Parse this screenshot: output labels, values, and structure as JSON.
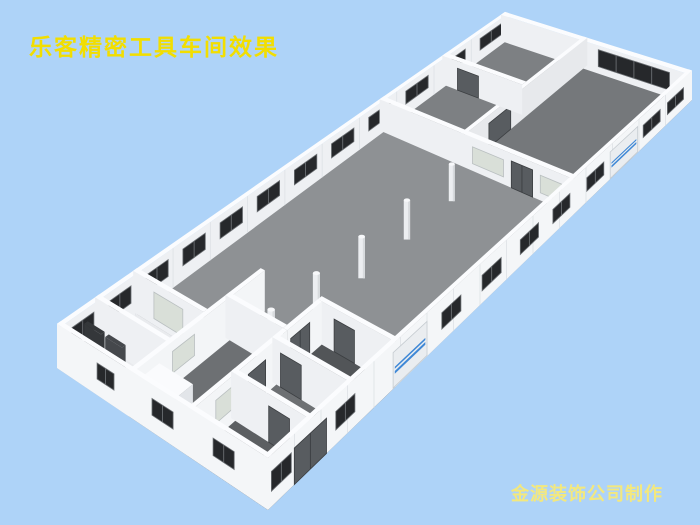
{
  "texts": {
    "title": "乐客精密工具车间效果",
    "credit": "金源装饰公司制作",
    "title_color": "#f2de00",
    "credit_color": "#f3e87e"
  },
  "background_color": "#aed3f8",
  "scene": {
    "description": "bird's-eye 3D render of workshop floor plan: long white building, gray hall floor, row of columns, office rooms at both ends, dark windows, blue-striped roll-up doors",
    "proj": {
      "W": [
        57,
        368
      ],
      "N": [
        505,
        38
      ],
      "S": [
        268,
        510
      ],
      "E": [
        692,
        100
      ]
    },
    "h0": 24,
    "hs": 0.055,
    "ta": 0.009,
    "tb": 0.02,
    "colH": 1.06,
    "colW": 0.17,
    "rollStripes": [
      [
        0.36,
        0.44
      ],
      [
        0.5,
        0.56
      ]
    ],
    "colors": {
      "wallTop": "#fbfcfe",
      "wallIn": "#eef0f3",
      "wallBright": "#f3f5f7",
      "wallMid": "#e7e9ec",
      "wallExt": "#f4f6f8",
      "seam": "#dde1e5",
      "floorHall": "#8e9194",
      "floorRoomA": "#7d8083",
      "floorRoomB": "#75787b",
      "floorRoomC": "#6d7073",
      "floorDark": "#5c5f62",
      "floorDark2": "#525558",
      "floorBath": "#e9ebee",
      "win": "#26282b",
      "winFrame": "#6a6e72",
      "frost": "#d9dfd8",
      "frostFrame": "#b9bfc0",
      "door": "#585c60",
      "doorFrame": "#3b3e41",
      "roll": "#eaedf0",
      "rollFrame": "#c6ccd1",
      "rollStripe": "#3f88d6",
      "colBody": "#eceef1",
      "colShade": "#d8dbde",
      "colTop": "#f7f8fa",
      "panelDark": "#34373a",
      "panelDark2": "#45484c",
      "boxTop": "#fafbfd",
      "boxFaceA": "#eef0f3",
      "boxFaceB": "#e2e5e9"
    },
    "floors": [
      {
        "a": [
          0,
          1
        ],
        "b": [
          0,
          1
        ],
        "c": "floorHall",
        "name": "main-hall-floor"
      },
      {
        "a": [
          0.72,
          1
        ],
        "b": [
          0,
          0.42
        ],
        "c": "floorRoomA",
        "name": "office-strip-floor"
      },
      {
        "a": [
          0.72,
          1
        ],
        "b": [
          0.42,
          1
        ],
        "c": "floorRoomB",
        "name": "big-office-floor"
      },
      {
        "a": [
          0,
          0.22
        ],
        "b": [
          0.34,
          0.62
        ],
        "c": "floorRoomC",
        "name": "corridor-floor"
      },
      {
        "a": [
          0,
          0.3
        ],
        "b": [
          0.62,
          1
        ],
        "c": "floorRoomC",
        "name": "rooms-floor"
      },
      {
        "a": [
          0,
          0.1
        ],
        "b": [
          0.62,
          1
        ],
        "c": "floorDark",
        "name": "room-floor-dark"
      },
      {
        "a": [
          0.22,
          0.3
        ],
        "b": [
          0.62,
          1
        ],
        "c": "floorDark2",
        "name": "corner-room-floor"
      },
      {
        "a": [
          0,
          0.17
        ],
        "b": [
          0,
          0.34
        ],
        "c": "floorBath",
        "name": "washroom-floor"
      }
    ],
    "columns": [
      [
        0.65,
        0.53
      ],
      [
        0.547,
        0.53
      ],
      [
        0.443,
        0.53
      ],
      [
        0.339,
        0.53
      ],
      [
        0.235,
        0.53
      ]
    ],
    "objects": [
      {
        "kind": "wall",
        "name": "nw-exterior-wall",
        "t": "L",
        "b": 0,
        "a1": 0,
        "a2": 1,
        "face": "wallIn",
        "seams": 0.0833,
        "f": [
          {
            "kind": "winrow",
            "start": 0.048,
            "step": 0.083,
            "n": 12,
            "w": 0.05,
            "v": [
              0.38,
              0.8
            ],
            "panes": 2
          }
        ]
      },
      {
        "kind": "wall",
        "name": "ne-exterior-wall",
        "t": "C",
        "a": 0.991,
        "b1": 0,
        "b2": 1,
        "face": "wallIn",
        "f": [
          {
            "kind": "win",
            "r": [
              0.52,
              0.9
            ],
            "v": [
              0.25,
              0.85
            ],
            "panes": 4
          }
        ]
      },
      {
        "kind": "wall",
        "name": "office-long-partition",
        "t": "L",
        "b": 0.42,
        "a1": 0.72,
        "a2": 1,
        "face": "wallMid",
        "f": [
          {
            "kind": "door",
            "r": [
              0.775,
              0.825
            ],
            "v": [
              0,
              0.75
            ]
          }
        ]
      },
      {
        "kind": "wall",
        "name": "office-cross-partition",
        "t": "C",
        "a": 0.86,
        "b1": 0,
        "b2": 0.42,
        "face": "wallIn",
        "f": [
          {
            "kind": "door",
            "r": [
              0.08,
              0.19
            ],
            "v": [
              0,
              0.75
            ]
          }
        ]
      },
      {
        "kind": "wall",
        "name": "hall-office-partition",
        "t": "C",
        "a": 0.72,
        "b1": 0,
        "b2": 1,
        "face": "wallIn",
        "f": [
          {
            "kind": "frost",
            "r": [
              0.48,
              0.64
            ],
            "v": [
              0.22,
              0.72
            ]
          },
          {
            "kind": "door",
            "r": [
              0.68,
              0.79
            ],
            "v": [
              0,
              0.78
            ],
            "panes": 2
          },
          {
            "kind": "frost",
            "r": [
              0.83,
              0.94
            ],
            "v": [
              0.22,
              0.72
            ]
          }
        ]
      },
      {
        "kind": "columns"
      },
      {
        "kind": "wall",
        "name": "washroom-wall-ne",
        "t": "C",
        "a": 0.17,
        "b1": 0,
        "b2": 0.34,
        "face": "wallIn",
        "f": [
          {
            "kind": "frost",
            "r": [
              0.1,
              0.24
            ],
            "v": [
              0.15,
              0.78
            ]
          }
        ]
      },
      {
        "kind": "box",
        "name": "washroom-fixture",
        "a1": 0.09,
        "a2": 0.125,
        "b1": 0.05,
        "b2": 0.13,
        "k": 0.32
      },
      {
        "kind": "box",
        "name": "washroom-fixture",
        "a1": 0.09,
        "a2": 0.125,
        "b1": 0.16,
        "b2": 0.24,
        "k": 0.32
      },
      {
        "kind": "box",
        "name": "washroom-counter",
        "a1": 0.1,
        "a2": 0.14,
        "b1": 0.26,
        "b2": 0.33,
        "k": 0.26
      },
      {
        "kind": "wall",
        "name": "washroom-partition",
        "t": "C",
        "a": 0.085,
        "b1": 0,
        "b2": 0.34,
        "face": "wallIn"
      },
      {
        "kind": "box",
        "name": "dark-partition-panel",
        "a1": 0.042,
        "a2": 0.05,
        "b1": 0.04,
        "b2": 0.12,
        "k": 0.82,
        "fa": "panelDark",
        "fb": "panelDark",
        "top": "panelDark"
      },
      {
        "kind": "box",
        "name": "dark-partition-panel",
        "a1": 0.042,
        "a2": 0.05,
        "b1": 0.14,
        "b2": 0.22,
        "k": 0.82,
        "fa": "panelDark2",
        "fb": "panelDark2",
        "top": "panelDark2"
      },
      {
        "kind": "wall",
        "name": "corridor-wall",
        "t": "L",
        "b": 0.34,
        "a1": 0,
        "a2": 0.3,
        "face": "wallBright",
        "f": [
          {
            "kind": "frost",
            "r": [
              0.09,
              0.14
            ],
            "v": [
              0.3,
              0.78
            ]
          }
        ]
      },
      {
        "kind": "box",
        "name": "low-room-block",
        "a1": 0.005,
        "a2": 0.06,
        "b1": 0.36,
        "b2": 0.52,
        "k": 0.75
      },
      {
        "kind": "wall",
        "name": "corner-room-wall-ne",
        "t": "C",
        "a": 0.3,
        "b1": 0.62,
        "b2": 1,
        "face": "wallIn",
        "f": [
          {
            "kind": "door",
            "r": [
              0.7,
              0.8
            ],
            "v": [
              0,
              0.75
            ]
          }
        ]
      },
      {
        "kind": "wall",
        "name": "corner-room-wall-nw",
        "t": "L",
        "b": 0.62,
        "a1": 0.22,
        "a2": 0.3,
        "face": "wallBright",
        "f": [
          {
            "kind": "door",
            "r": [
              0.228,
              0.272
            ],
            "v": [
              0,
              0.75
            ],
            "panes": 2
          }
        ]
      },
      {
        "kind": "wall",
        "name": "corridor-end-wall",
        "t": "C",
        "a": 0.22,
        "b1": 0.34,
        "b2": 0.62,
        "face": "wallIn"
      },
      {
        "kind": "wall",
        "name": "rooms-wall",
        "t": "L",
        "b": 0.62,
        "a1": 0,
        "a2": 0.22,
        "face": "wallBright",
        "f": [
          {
            "kind": "frost",
            "r": [
              0.055,
              0.105
            ],
            "v": [
              0.3,
              0.78
            ]
          },
          {
            "kind": "door",
            "r": [
              0.13,
              0.17
            ],
            "v": [
              0,
              0.75
            ]
          }
        ]
      },
      {
        "kind": "wall",
        "name": "rooms-divider-1",
        "t": "C",
        "a": 0.195,
        "b1": 0.62,
        "b2": 1,
        "face": "wallIn",
        "f": [
          {
            "kind": "door",
            "r": [
              0.66,
              0.76
            ],
            "v": [
              0,
              0.75
            ]
          }
        ]
      },
      {
        "kind": "wall",
        "name": "rooms-divider-2",
        "t": "C",
        "a": 0.1,
        "b1": 0.62,
        "b2": 1,
        "face": "wallIn",
        "f": [
          {
            "kind": "door",
            "r": [
              0.8,
              0.9
            ],
            "v": [
              0,
              0.75
            ]
          }
        ]
      },
      {
        "kind": "wall",
        "name": "sw-exterior-wall",
        "t": "C",
        "a": 0,
        "b1": 0,
        "b2": 1,
        "face": "wallExt",
        "f": [
          {
            "kind": "win",
            "r": [
              0.19,
              0.27
            ],
            "v": [
              0.35,
              0.7
            ],
            "panes": 2
          },
          {
            "kind": "win",
            "r": [
              0.45,
              0.55
            ],
            "v": [
              0.35,
              0.7
            ],
            "panes": 2
          },
          {
            "kind": "win",
            "r": [
              0.74,
              0.84
            ],
            "v": [
              0.35,
              0.7
            ],
            "panes": 2
          }
        ]
      },
      {
        "kind": "wall",
        "name": "se-exterior-wall",
        "t": "L",
        "b": 0.98,
        "a1": 0,
        "a2": 1,
        "face": "wallExt",
        "seams": 0.0625,
        "f": [
          {
            "kind": "win",
            "r": [
              0.008,
              0.055
            ],
            "v": [
              0.3,
              0.68
            ],
            "panes": 2
          },
          {
            "kind": "door",
            "r": [
              0.062,
              0.138
            ],
            "v": [
              0,
              0.72
            ],
            "panes": 2
          },
          {
            "kind": "win",
            "r": [
              0.16,
              0.205
            ],
            "v": [
              0.3,
              0.68
            ],
            "panes": 2
          },
          {
            "kind": "roll",
            "r": [
              0.295,
              0.375
            ],
            "v": [
              0.02,
              0.8
            ]
          },
          {
            "kind": "win",
            "r": [
              0.41,
              0.455
            ],
            "v": [
              0.3,
              0.68
            ],
            "panes": 2
          },
          {
            "kind": "win",
            "r": [
              0.505,
              0.55
            ],
            "v": [
              0.3,
              0.68
            ],
            "panes": 2
          },
          {
            "kind": "win",
            "r": [
              0.595,
              0.638
            ],
            "v": [
              0.3,
              0.68
            ],
            "panes": 2
          },
          {
            "kind": "win",
            "r": [
              0.672,
              0.712
            ],
            "v": [
              0.3,
              0.68
            ],
            "panes": 2
          },
          {
            "kind": "win",
            "r": [
              0.752,
              0.792
            ],
            "v": [
              0.3,
              0.68
            ],
            "panes": 2
          },
          {
            "kind": "roll",
            "r": [
              0.807,
              0.872
            ],
            "v": [
              0.02,
              0.8
            ]
          },
          {
            "kind": "win",
            "r": [
              0.885,
              0.925
            ],
            "v": [
              0.3,
              0.68
            ],
            "panes": 2
          },
          {
            "kind": "win",
            "r": [
              0.942,
              0.98
            ],
            "v": [
              0.3,
              0.68
            ],
            "panes": 2
          }
        ]
      }
    ]
  }
}
